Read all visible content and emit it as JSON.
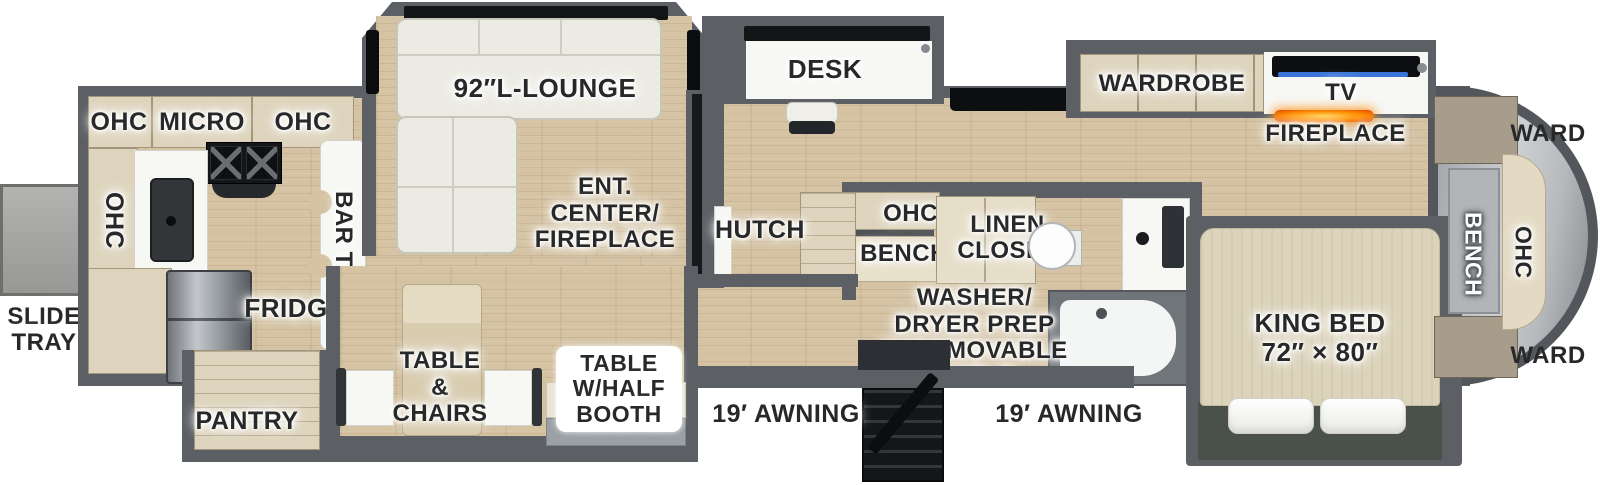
{
  "title": "Fifth wheel RV floorplan (top view)",
  "colors": {
    "wall": "#5c6064",
    "floor": "#d5c3a3",
    "cabinet": "#ded4bd",
    "fireplace_glow": "#ff8a00",
    "tv_screen_blue": "#3a74d9",
    "bed_slide_green": "#49514a",
    "front_cap_silver": "#cdd0d3"
  },
  "exterior": {
    "slide_tray": "SLIDE\nTRAY",
    "awning_door": "19′ AWNING",
    "awning_bedroom": "19′ AWNING"
  },
  "kitchen": {
    "ohc_rear": "OHC",
    "micro": "MICRO",
    "ohc_front": "OHC",
    "ohc_side": "OHC",
    "bar_top": "BAR TOP",
    "fridge": "FRIDGE",
    "pantry": "PANTRY"
  },
  "living": {
    "lounge": "92″L-LOUNGE",
    "ent_center": "ENT.\nCENTER/\nFIREPLACE",
    "desk": "DESK",
    "hutch": "HUTCH",
    "table_chairs": "TABLE\n&\nCHAIRS",
    "table_booth": "TABLE\nW/HALF\nBOOTH"
  },
  "bath": {
    "ohc": "OHC",
    "bench": "BENCH",
    "linen_closet": "LINEN\nCLOSET",
    "washer": "WASHER/\nDRYER PREP\nW/REMOVABLE\nSHELF"
  },
  "bedroom": {
    "wardrobe": "WARDROBE",
    "tv": "TV",
    "fireplace": "FIREPLACE",
    "king_bed": "KING BED\n72″ × 80″",
    "ward_front_top": "WARD",
    "ward_front_bottom": "WARD",
    "bench": "BENCH",
    "ohc": "OHC"
  }
}
